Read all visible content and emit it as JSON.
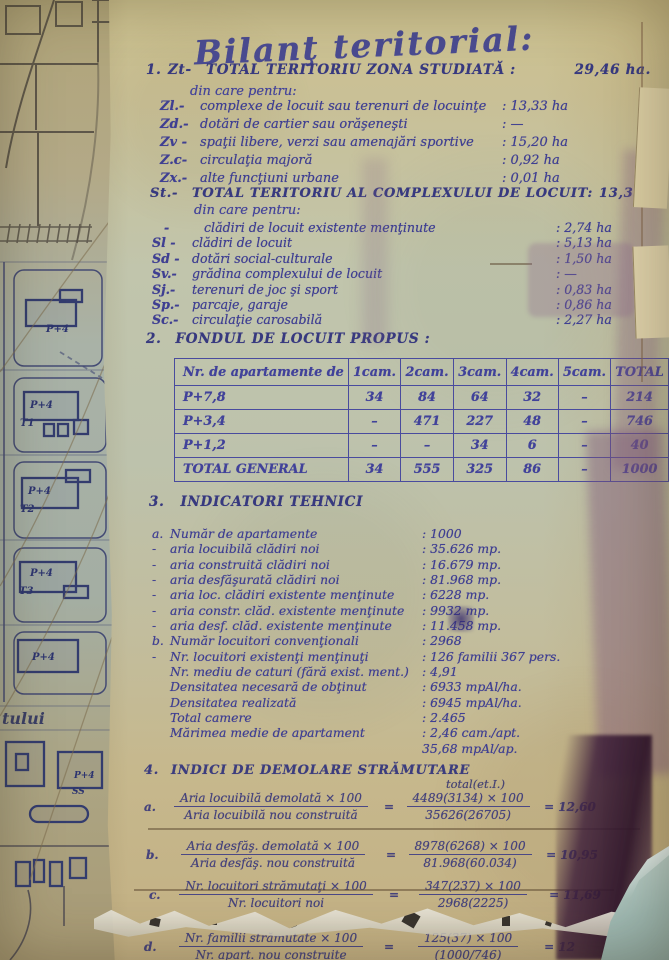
{
  "ink_color": "#3f3f92",
  "title": "Bilanţ teritorial:",
  "section1": {
    "number": "1.",
    "code": "Zt-",
    "heading": "TOTAL TERITORIU ZONA STUDIATĂ :",
    "value": "29,46 ha.",
    "subnote": "din care pentru:",
    "items": [
      {
        "code": "Zl.-",
        "label": "complexe de locuit sau terenuri de locuinţe",
        "value": ": 13,33 ha"
      },
      {
        "code": "Zd.-",
        "label": "dotări de cartier sau orăşeneşti",
        "value": ": —"
      },
      {
        "code": "Zv -",
        "label": "spaţii libere, verzi sau amenajări sportive",
        "value": ": 15,20 ha"
      },
      {
        "code": "Z.c-",
        "label": "circulaţia majoră",
        "value": ": 0,92 ha"
      },
      {
        "code": "Zx.-",
        "label": "alte funcţiuni urbane",
        "value": ": 0,01 ha"
      }
    ]
  },
  "sectionSt": {
    "code": "St.-",
    "heading": "TOTAL TERITORIU AL COMPLEXULUI DE LOCUIT:",
    "value": "13,33 ha",
    "subnote": "din care pentru:",
    "items": [
      {
        "code": "-",
        "label": "clădiri de locuit existente menţinute",
        "value": ": 2,74 ha"
      },
      {
        "code": "Sl -",
        "label": "clădiri de locuit",
        "value": ": 5,13 ha"
      },
      {
        "code": "Sd -",
        "label": "dotări social-culturale",
        "value": ": 1,50 ha"
      },
      {
        "code": "Sv.-",
        "label": "grădina complexului de locuit",
        "value": ": —"
      },
      {
        "code": "Sj.-",
        "label": "terenuri de joc şi sport",
        "value": ": 0,83 ha"
      },
      {
        "code": "Sp.-",
        "label": "parcaje, garaje",
        "value": ": 0,86 ha"
      },
      {
        "code": "Sc.-",
        "label": "circulaţie carosabilă",
        "value": ": 2,27 ha"
      }
    ]
  },
  "section2": {
    "number": "2.",
    "heading": "FONDUL DE LOCUIT PROPUS :",
    "table": {
      "headers": [
        "Nr. de apartamente de",
        "1cam.",
        "2cam.",
        "3cam.",
        "4cam.",
        "5cam.",
        "TOTAL"
      ],
      "rows": [
        {
          "label": "P+7,8",
          "cells": [
            "34",
            "84",
            "64",
            "32",
            "–",
            "214"
          ]
        },
        {
          "label": "P+3,4",
          "cells": [
            "–",
            "471",
            "227",
            "48",
            "–",
            "746"
          ]
        },
        {
          "label": "P+1,2",
          "cells": [
            "–",
            "–",
            "34",
            "6",
            "–",
            "40"
          ]
        },
        {
          "label": "TOTAL GENERAL",
          "cells": [
            "34",
            "555",
            "325",
            "86",
            "–",
            "1000"
          ]
        }
      ]
    }
  },
  "section3": {
    "number": "3.",
    "heading": "INDICATORI TEHNICI",
    "items": [
      {
        "prefix": "a.",
        "label": "Număr de apartamente",
        "value": ":  1000"
      },
      {
        "prefix": "-",
        "label": "aria locuibilă clădiri noi",
        "value": ": 35.626 mp."
      },
      {
        "prefix": "-",
        "label": "aria construită clădiri noi",
        "value": ": 16.679 mp."
      },
      {
        "prefix": "-",
        "label": "aria desfăşurată clădiri noi",
        "value": ": 81.968 mp."
      },
      {
        "prefix": "-",
        "label": "aria loc. clădiri existente menţinute",
        "value": ": 6228 mp."
      },
      {
        "prefix": "-",
        "label": "aria constr. clăd. existente menţinute",
        "value": ": 9932 mp."
      },
      {
        "prefix": "-",
        "label": "aria desf. clăd. existente menţinute",
        "value": ": 11.458 mp."
      },
      {
        "prefix": "b.",
        "label": "Număr locuitori convenţionali",
        "value": ": 2968"
      },
      {
        "prefix": "-",
        "label": "Nr. locuitori existenţi menţinuţi",
        "value": ": 126 familii 367 pers."
      },
      {
        "prefix": "",
        "label": "Nr. mediu de caturi (fără exist. ment.)",
        "value": ": 4,91"
      },
      {
        "prefix": "",
        "label": "Densitatea necesară de obţinut",
        "value": ": 6933 mpAl/ha."
      },
      {
        "prefix": "",
        "label": "Densitatea realizată",
        "value": ": 6945 mpAl/ha."
      },
      {
        "prefix": "",
        "label": "Total camere",
        "value": ": 2.465"
      },
      {
        "prefix": "",
        "label": "Mărimea medie de apartament",
        "value": ": 2,46 cam./apt."
      },
      {
        "prefix": "",
        "label": "",
        "value": "35,68 mpAl/ap."
      }
    ]
  },
  "section4": {
    "number": "4.",
    "heading": "INDICI DE DEMOLARE STRĂMUTARE",
    "note": "total(et.I.)",
    "formulas": [
      {
        "letter": "a.",
        "num": "Aria locuibilă demolată × 100",
        "den": "Aria locuibilă nou construită",
        "eq": "=",
        "num2": "4489(3134) × 100",
        "den2": "35626(26705)",
        "res": "= 12,60"
      },
      {
        "letter": "b.",
        "num": "Aria desfăş. demolată × 100",
        "den": "Aria desfăş. nou construită",
        "eq": "=",
        "num2": "8978(6268) × 100",
        "den2": "81.968(60.034)",
        "res": "= 10,95"
      },
      {
        "letter": "c.",
        "num": "Nr. locuitori strămutaţi × 100",
        "den": "Nr. locuitori noi",
        "eq": "=",
        "num2": "347(237) × 100",
        "den2": "2968(2225)",
        "res": "= 11,69"
      },
      {
        "letter": "d.",
        "num": "Nr. familii strămutate × 100",
        "den": "Nr. apart. nou construite",
        "eq": "=",
        "num2": "125(37) × 100",
        "den2": "(1000/746)",
        "res": "= 12"
      }
    ]
  },
  "map": {
    "labels": [
      "P+4",
      "P+4",
      "T1",
      "P+4",
      "T2",
      "P+4",
      "T3",
      "P+4",
      "tului",
      "P+4",
      "SS"
    ]
  }
}
